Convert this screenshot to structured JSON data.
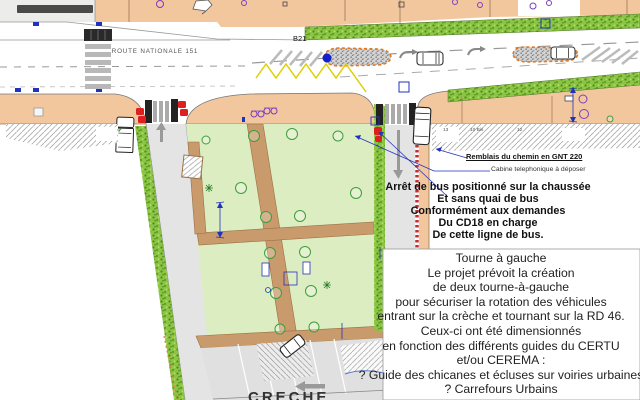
{
  "plan": {
    "road_label": "ROUTE NATIONALE 151",
    "stop_code": "B21",
    "creche_label": "CRECHE",
    "parcels": {
      "p1": "13",
      "p2": "10 Bis",
      "p3": "12"
    }
  },
  "annotations": {
    "remblais": "Remblais du chemin en GNT 220",
    "cabine": "Cabine telephonique à déposer",
    "bus_note_lines": [
      "Arrêt de bus positionné sur la chaussée",
      "Et sans quai de bus",
      "Conformément aux demandes",
      "Du CD18 en charge",
      "De cette ligne de bus."
    ],
    "turn_note_lines": [
      "Tourne à gauche",
      "Le projet prévoit la création",
      "de deux tourne-à-gauche",
      "pour sécuriser la rotation des véhicules",
      "entrant sur la crèche et tournant sur la RD 46.",
      "Ceux-ci ont été dimensionnés",
      "en fonction des différents guides du CERTU",
      "et/ou CEREMA :",
      "? Guide des chicanes et écluses sur voiries urbaines",
      "? Carrefours Urbains"
    ]
  },
  "colors": {
    "sidewalk": "#f2c79e",
    "park_green": "#dcedc2",
    "verge_green": "#8cc544",
    "path_tan": "#c99a6b",
    "side_road": "#e4e4e4",
    "cad_blue": "#2233bb",
    "alert_red": "#dd1f1f",
    "marking_yellow": "#ddd000",
    "median_border_orange": "#e07820"
  }
}
